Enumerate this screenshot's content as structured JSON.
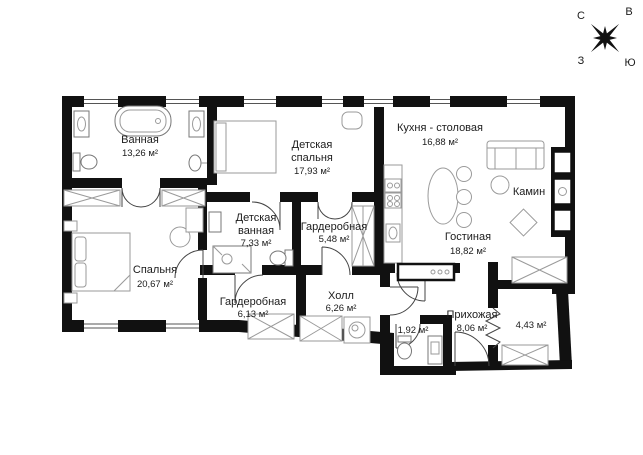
{
  "title": "Apartment floor plan",
  "compass": {
    "north": "С",
    "east": "В",
    "west": "З",
    "south": "Ю"
  },
  "colors": {
    "wall": "#111111",
    "furniture": "#9a9a9a",
    "text": "#1c1c1c",
    "background": "#ffffff"
  },
  "rooms": {
    "bathroom": {
      "name": "Ванная",
      "area": "13,26 м²"
    },
    "kids_bedroom": {
      "name1": "Детская",
      "name2": "спальня",
      "area": "17,93 м²"
    },
    "kitchen": {
      "name": "Кухня - столовая",
      "area": "16,88 м²"
    },
    "fireplace": {
      "name": "Камин"
    },
    "living": {
      "name": "Гостиная",
      "area": "18,82 м²"
    },
    "kids_bath": {
      "name1": "Детская",
      "name2": "ванная",
      "area": "7,33 м²"
    },
    "wardrobe_small": {
      "name": "Гардеробная",
      "area": "5,48 м²"
    },
    "bedroom": {
      "name": "Спальня",
      "area": "20,67 м²"
    },
    "wardrobe_big": {
      "name": "Гардеробная",
      "area": "6,13 м²"
    },
    "hall": {
      "name": "Холл",
      "area": "6,26 м²"
    },
    "wc": {
      "area": "1,92 м²"
    },
    "entry": {
      "name": "Прихожая",
      "area": "8,06 м²"
    },
    "storage": {
      "area": "4,43 м²"
    }
  }
}
